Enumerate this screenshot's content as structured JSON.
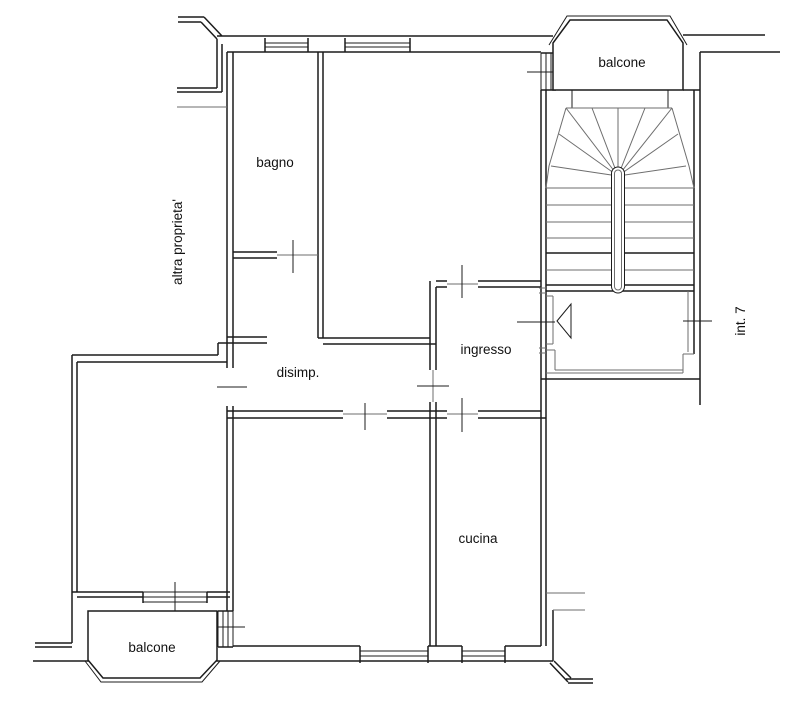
{
  "plan": {
    "type": "apartment-floor-plan",
    "background_color": "#ffffff",
    "wall_color": "#1c1c1c",
    "thin_line_color": "#6e6e6e",
    "labels": {
      "balcone_top": "balcone",
      "bagno": "bagno",
      "altra_proprieta": "altra proprieta'",
      "ingresso": "ingresso",
      "int_7": "int. 7",
      "disimp": "disimp.",
      "cucina": "cucina",
      "balcone_bottom": "balcone"
    }
  }
}
